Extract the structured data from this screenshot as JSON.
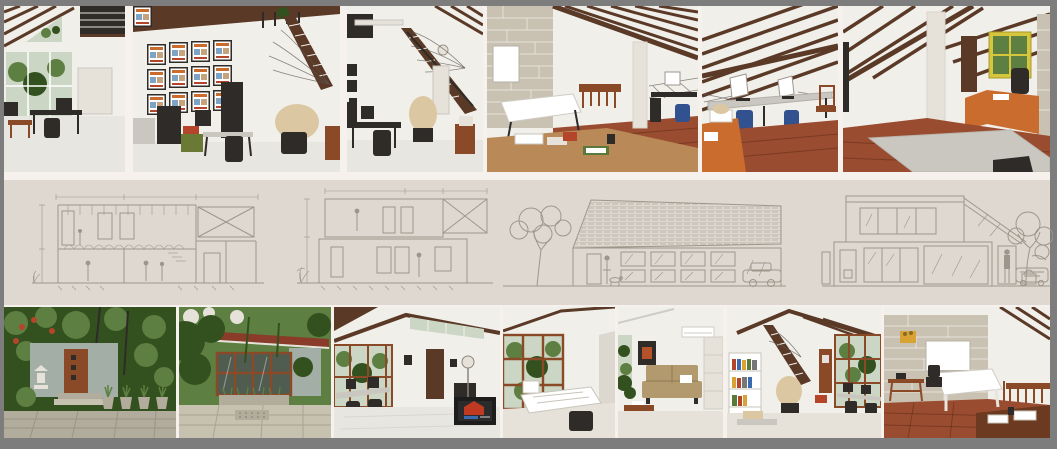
{
  "board": {
    "description": "Architecture studio presentation board: photo collage of a studio house with architectural section and elevation drawings"
  },
  "palette": {
    "border": "#7d7d7d",
    "gap": "#f6f1ed",
    "band": "#ded8d1",
    "line": "#9f968b",
    "wall": "#f1efea",
    "beam": "#5a3927",
    "tile": "#e8e6e0",
    "wood": "#9a4c30",
    "glass": "#ccd6c4",
    "glassD": "#515c51",
    "leaf": "#5d7f41",
    "leafD": "#33511f",
    "door": "#8a4a28",
    "orange": "#c96c2e",
    "dark": "#2e2b28",
    "gray": "#c9c7c0",
    "pale": "#e6e2da",
    "brick": "#c9c1b1",
    "yellow": "#d6c63e",
    "sofa": "#b29a6e",
    "pave": "#b1ac9b",
    "pave2": "#c7c2b0",
    "blue": "#32518f",
    "cloth": "#dbc8a2",
    "roof": "#8a3b2a",
    "red": "#b5452a",
    "crate": "#d8a332",
    "wallg": "#a3afa6",
    "screen": "#1d1d1d"
  },
  "top_photos": [
    {
      "desc": "Gabled studio interior with triangle window, mezzanine slats, glass wall to garden and work desk"
    },
    {
      "desc": "Studio wall with grid of framed posters, work desks with monitors and printer, stair with wire railing, cloth-covered chair"
    },
    {
      "desc": "White studio with wooden staircase, fan wire railing, desk with monitor and covered chair"
    },
    {
      "desc": "Mezzanine with limestone block wall, whiteboard, drafting table, wooden bench, column and computer desk on wooden floor"
    },
    {
      "desc": "Attic workspace under diagonal timber rafters with desk row, blue chairs and orange cabinet"
    },
    {
      "desc": "Attic meeting area with white column, yellow-framed window, orange desk and large grey table"
    }
  ],
  "drawings": [
    {
      "desc": "Longitudinal section: studio with mezzanine, hanger roof structure, figures and stair"
    },
    {
      "desc": "Cross section: two stacked rooms with figures, scaffold truss and planting"
    },
    {
      "desc": "Front elevation: long tiled roof, window grid, entry with figure, tree, dog and car"
    },
    {
      "desc": "Side elevation: two-storey block, sloped roof, glazing, figure at door, tree and car"
    }
  ],
  "bottom_photos": [
    {
      "desc": "Garden entrance with brown slatted door, stone lantern, potted plants and paving"
    },
    {
      "desc": "Garden court with red tile roof, timber-framed glazing and planters"
    },
    {
      "desc": "Studio interior with glass wall, clerestory, dark door and TV showing red graphic"
    },
    {
      "desc": "Tall timber-framed window wall beside desk stacked with papers"
    },
    {
      "desc": "Lounge corner with tan futon sofa, dark painting and coffee table"
    },
    {
      "desc": "Studio with white bookshelf, stair with covered chair and timber glazing with desks"
    },
    {
      "desc": "Room with limestone block wall, whiteboard, white table and timber stair rail on wooden floor"
    }
  ]
}
